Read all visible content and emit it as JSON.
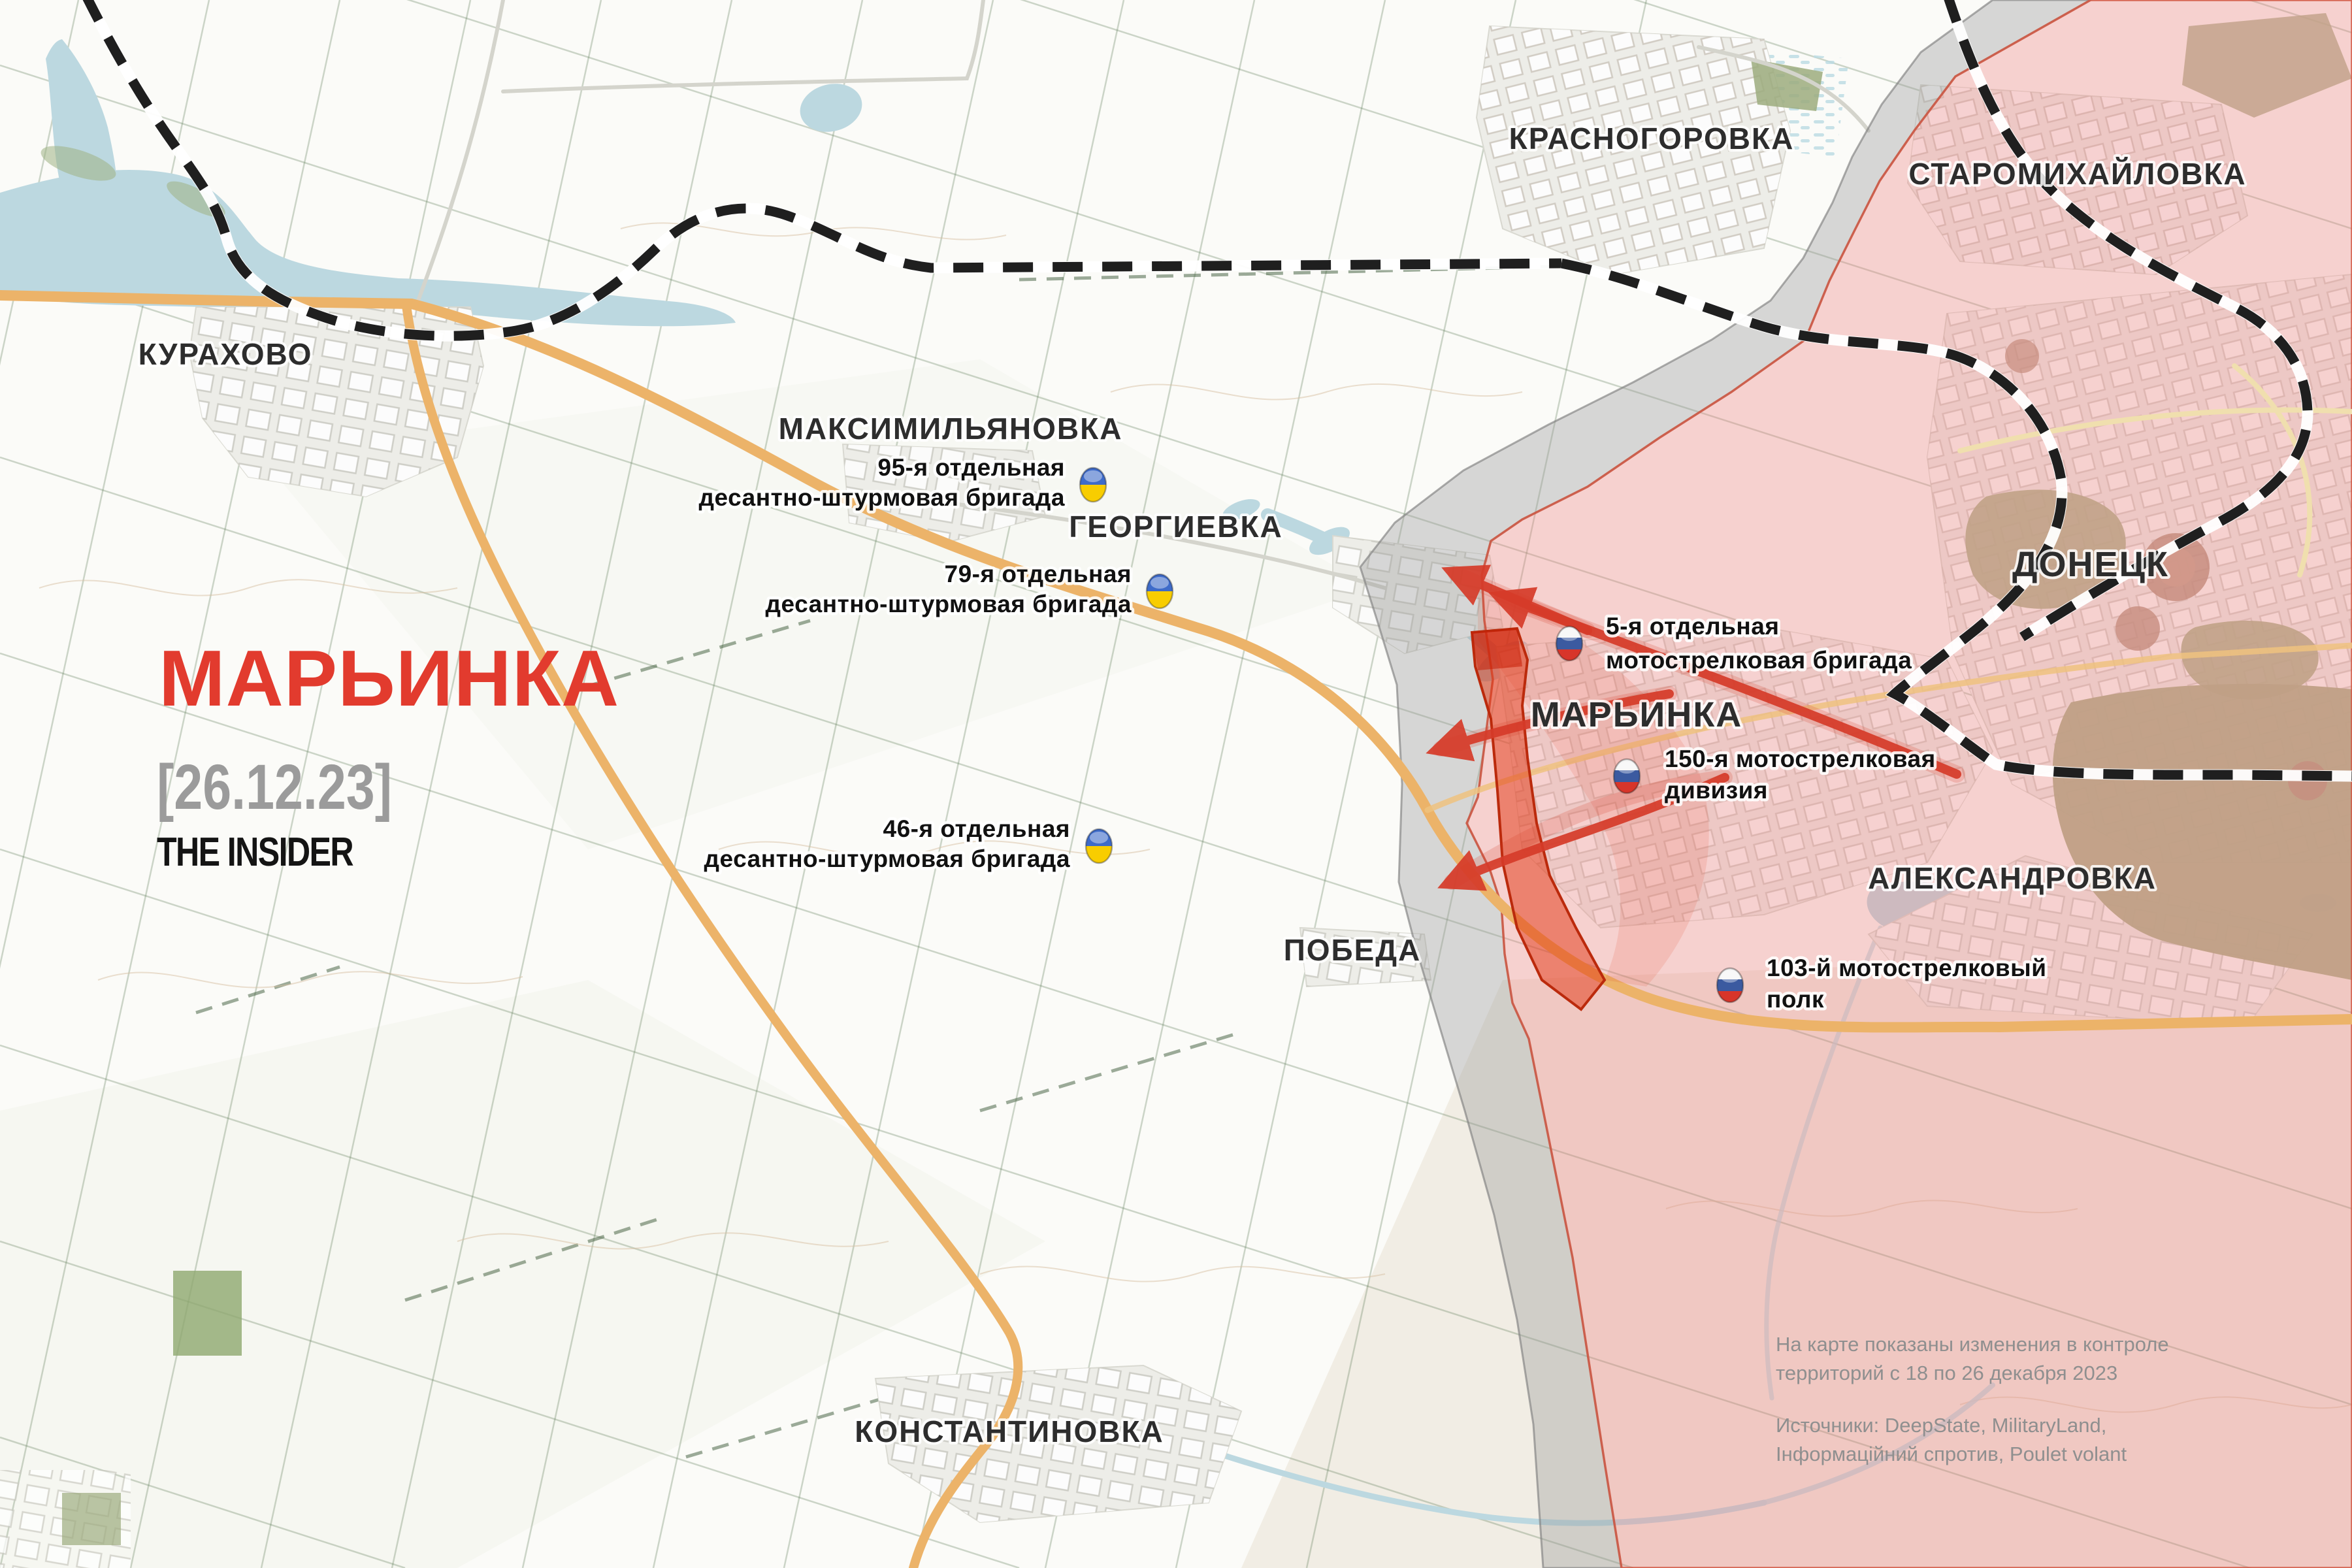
{
  "header": {
    "title": "МАРЬИНКА",
    "date": "[26.12.23]",
    "brand": "THE INSIDER"
  },
  "cities": [
    {
      "name": "kurakhovo",
      "label": "КУРАХОВО"
    },
    {
      "name": "krasnohorivka",
      "label": "КРАСНОГОРОВКА"
    },
    {
      "name": "staromykhailivka",
      "label": "СТАРОМИХАЙЛОВКА"
    },
    {
      "name": "maksymilianivka",
      "label": "МАКСИМИЛЬЯНОВКА"
    },
    {
      "name": "heorhiivka",
      "label": "ГЕОРГИЕВКА"
    },
    {
      "name": "marinka",
      "label": "МАРЬИНКА"
    },
    {
      "name": "donetsk",
      "label": "ДОНЕЦК"
    },
    {
      "name": "oleksandrivka",
      "label": "АЛЕКСАНДРОВКА"
    },
    {
      "name": "pobieda",
      "label": "ПОБЕДА"
    },
    {
      "name": "kostiantynivka",
      "label": "КОНСТАНТИНОВКА"
    }
  ],
  "units": [
    {
      "name": "95th-separate-air-assault-brigade",
      "side": "ukraine",
      "line1": "95-я отдельная",
      "line2": "десантно-штурмовая бригада"
    },
    {
      "name": "79th-separate-air-assault-brigade",
      "side": "ukraine",
      "line1": "79-я отдельная",
      "line2": "десантно-штурмовая бригада"
    },
    {
      "name": "46th-separate-air-assault-brigade",
      "side": "ukraine",
      "line1": "46-я отдельная",
      "line2": "десантно-штурмовая бригада"
    },
    {
      "name": "5th-separate-motor-rifle-brigade",
      "side": "russia",
      "line1": "5-я отдельная",
      "line2": "мотострелковая бригада"
    },
    {
      "name": "150th-motor-rifle-division",
      "side": "russia",
      "line1": "150-я мотострелковая",
      "line2": "дивизия"
    },
    {
      "name": "103rd-motor-rifle-regiment",
      "side": "russia",
      "line1": "103-й мотострелковый",
      "line2": "полк"
    }
  ],
  "note": {
    "p1_line1": "На карте показаны изменения в контроле",
    "p1_line2": "территорий с 18 по 26 декабря 2023",
    "p2_line1": "Источники: DeepState, MilitaryLand,",
    "p2_line2": "Інформаційний спротив, Poulet volant"
  },
  "colors": {
    "title_red": "#e23b2e",
    "date_gray": "#9b9b9b",
    "brand_black": "#141414",
    "label_dark": "#2d2d2d",
    "unit_dark": "#111111",
    "note_gray": "#8f8f8f",
    "arrow_red": "#d63b29",
    "captured_red": "#e1330f",
    "captured_border": "#bb2a0c",
    "russian_zone_pink": "#ec8080",
    "russian_zone_border": "#d05540",
    "gray_zone": "#9c9c9c",
    "gray_zone_border": "#7f7f7f",
    "ua_blue": "#3e6bc9",
    "ua_yellow": "#f8cd00",
    "ru_white": "#f4f4f4",
    "ru_blue": "#3b5aa0",
    "ru_red": "#d8352a",
    "water_blue": "#bcd8e0",
    "road_orange": "#ecb369",
    "railway_black": "#1f1f1f"
  }
}
